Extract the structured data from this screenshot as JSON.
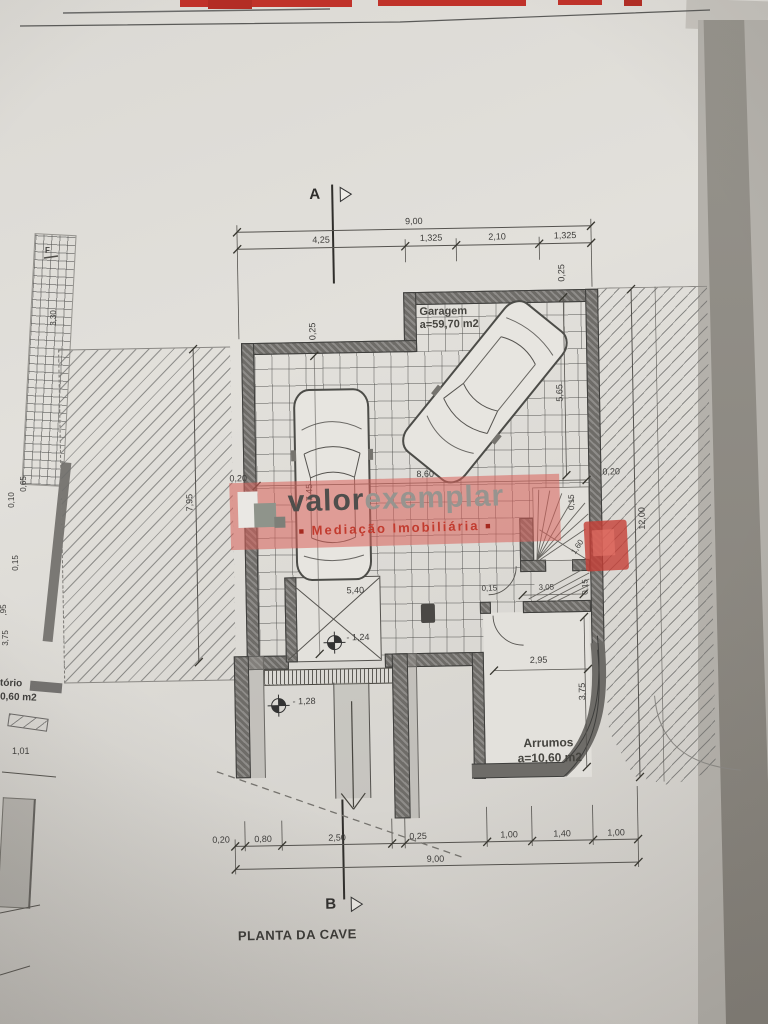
{
  "photo": {
    "backdrop_red": "#c0322a",
    "shadow_band_gray": "#908d86"
  },
  "watermark": {
    "brand1": "valor",
    "brand2": "exemplar",
    "tagline_bullet": "■",
    "tagline": "Mediação Imobiliária",
    "band_color": "#d9615a",
    "brand1_color": "#4f4e4c",
    "brand2_color": "#97948f",
    "tagline_color": "#c23b2f"
  },
  "plan": {
    "title": "PLANTA DA CAVE",
    "section_top": "A",
    "section_bottom": "B",
    "garage": {
      "name": "Garagem",
      "area": "a=59,70 m2"
    },
    "storage": {
      "name": "Arrumos",
      "area": "a=10,60 m2"
    },
    "levels": {
      "upper": "- 1,24",
      "lower": "- 1,28"
    },
    "dims": {
      "top_total": "9,00",
      "top_seg": [
        "4,25",
        "1,325",
        "2,10",
        "1,325"
      ],
      "bottom_seg": [
        "0,20",
        "0,80",
        "2,50",
        "0,25",
        "1,00",
        "1,40",
        "1,00"
      ],
      "bottom_total": "9,00",
      "left_outer": "7,95",
      "left_inner": "7,45",
      "left_wall": "0,20",
      "top_left_wall": "0,25",
      "top_right_wall": "0,25",
      "right_wall": "0,20",
      "right_total": "12,00",
      "right_inner": "5,65",
      "garage_width": "8,60",
      "mid_width": "5,40",
      "stair_wall_a": "0,15",
      "stair_wall_b": "0,15",
      "stair_wall_c": "0,15",
      "stair_width": "3,05",
      "stair_diag": "1,60",
      "storage_width": "2,95",
      "storage_height": "3,75"
    },
    "side_sketch": {
      "marker": "F",
      "dim_a": "3,30",
      "dim_b": "0,15",
      "dim_c": "0,65",
      "dim_d": "0,10",
      "dim_e": "3,75",
      "dim_f": ",95",
      "room_line1": "tório",
      "room_line2": "0,60 m2",
      "dim_g": "1,01"
    }
  }
}
